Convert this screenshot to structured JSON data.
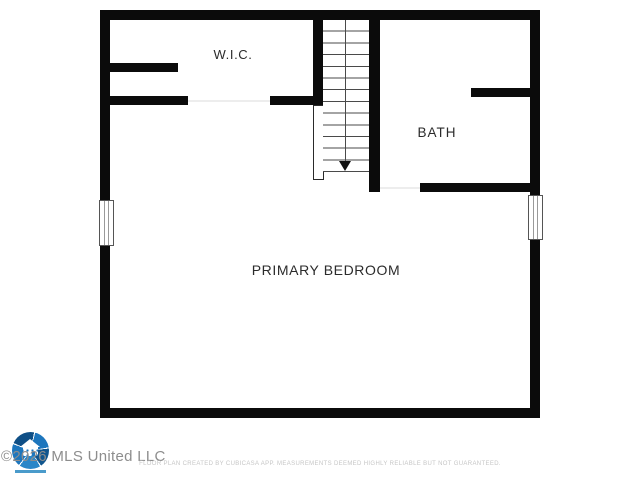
{
  "floor_plan": {
    "rooms": [
      {
        "id": "wic",
        "label": "W.I.C."
      },
      {
        "id": "bath",
        "label": "BATH"
      },
      {
        "id": "primary_bedroom",
        "label": "PRIMARY BEDROOM"
      }
    ],
    "stairs": {
      "direction": "down",
      "tread_count": 13
    },
    "window_count": 2,
    "doorway_count": 2,
    "colors": {
      "wall": "#0b0b0b",
      "floor": "#ffffff",
      "label_text": "#2b2b2b",
      "tread_line": "#4a4a4a",
      "door_threshold": "#ededed"
    }
  },
  "footer": {
    "watermark": "©2026 MLS United LLC",
    "disclaimer": "FLOOR PLAN CREATED BY CUBICASA APP. MEASUREMENTS DEEMED HIGHLY RELIABLE BUT NOT GUARANTEED.",
    "logo": {
      "name": "mls-united-logo",
      "primary_color": "#1d76bd",
      "secondary_color": "#0f4f86"
    }
  }
}
